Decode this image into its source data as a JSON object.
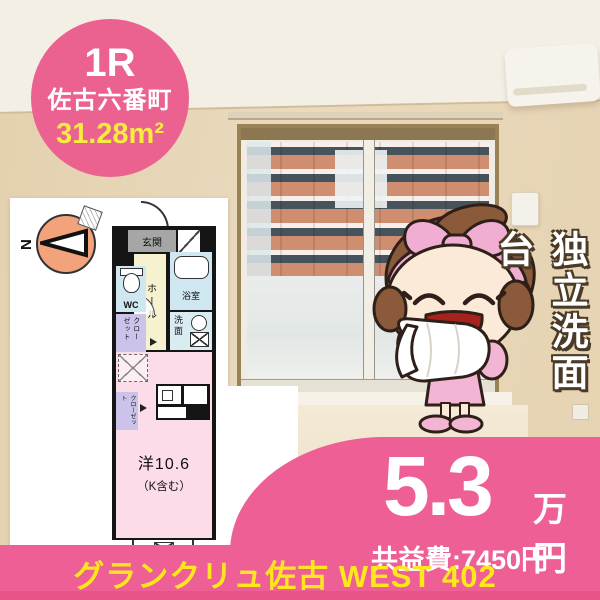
{
  "badge": {
    "layout_type": "1R",
    "location": "佐古六番町",
    "area": "31.28m²"
  },
  "floorplan": {
    "compass_north": "N",
    "entrance": "玄関",
    "hall": "ホール",
    "wc": "WC",
    "bath": "浴室",
    "wash": "洗面",
    "closet_upper": "クローゼット",
    "closet_lower": "クローゼット",
    "room_size": "洋10.6",
    "room_note": "（K含む）",
    "balcony": "バルコニー"
  },
  "feature_vertical": "独立洗面台",
  "price": {
    "rent": "5.3",
    "unit": "万円",
    "common_fee": "共益費:7450円"
  },
  "footer": {
    "building_name": "グランクリュ佐古 WEST 402"
  },
  "colors": {
    "accent_pink": "#ee5f95",
    "badge_pink": "#eb6190",
    "highlight_yellow": "#ffe61e",
    "area_yellow": "#f7ec3f",
    "plan_room_pink": "#fbdce8",
    "plan_wet_blue": "#cfe7f0",
    "plan_closet_purple": "#cbc3ea",
    "plan_hall_cream": "#f6f2cf",
    "compass_orange": "#f2a37c"
  }
}
